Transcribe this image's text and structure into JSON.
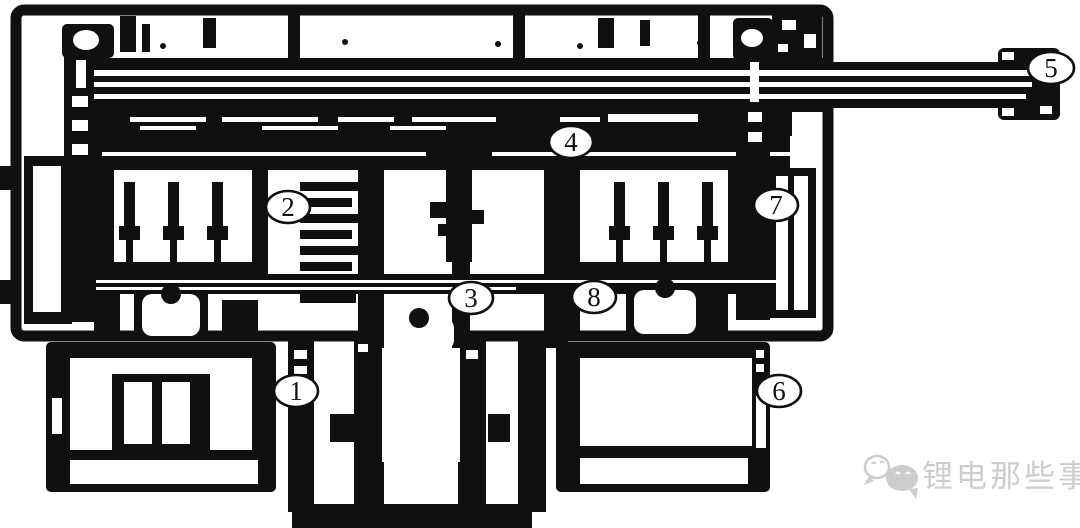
{
  "figure": {
    "balloons": [
      {
        "label": "1"
      },
      {
        "label": "2"
      },
      {
        "label": "3"
      },
      {
        "label": "4"
      },
      {
        "label": "5"
      },
      {
        "label": "6"
      },
      {
        "label": "7"
      },
      {
        "label": "8"
      }
    ],
    "watermark": {
      "text": "锂电那些事",
      "icon": "wechat-chat-bubbles-icon"
    },
    "colors": {
      "ink": "#101010",
      "paper": "#ffffff",
      "watermark": "#cdcdcd"
    }
  }
}
